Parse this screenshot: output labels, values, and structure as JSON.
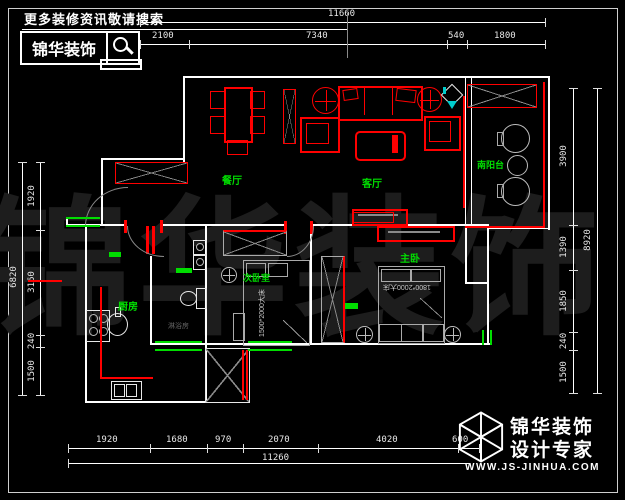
{
  "header": {
    "promo_text": "更多装修资讯敬请搜索",
    "brand": "锦华装饰"
  },
  "watermark": {
    "text": "锦华装饰"
  },
  "plan": {
    "room_labels": {
      "dining": "餐厅",
      "living": "客厅",
      "balcony": "南阳台",
      "second_bedroom": "次卧室",
      "master_bedroom": "主卧",
      "kitchen": "厨房",
      "shower": "淋浴房"
    },
    "furniture_text": {
      "second_bed": "1500*2000大床",
      "master_bed": "1800*2000大床"
    }
  },
  "dimensions": {
    "top": {
      "total": "11660",
      "segments": [
        "2100",
        "7340",
        "540",
        "1800"
      ]
    },
    "bottom": {
      "total": "11260",
      "segments": [
        "1920",
        "1680",
        "970",
        "2070",
        "4020",
        "600"
      ]
    },
    "left": {
      "total": "6820",
      "segments": [
        "1920",
        "3160",
        "240",
        "1500"
      ]
    },
    "right": {
      "total": "8920",
      "segments": [
        "3900",
        "1390",
        "1850",
        "240",
        "1500"
      ]
    }
  },
  "footer_logo": {
    "brand": "锦华装饰",
    "tagline": "设计专家",
    "website": "WWW.JS-JINHUA.COM"
  },
  "colors": {
    "wall": "#ffffff",
    "furniture_red": "#ff0000",
    "label_green": "#00dd00",
    "dim_text": "#e8e8e8",
    "watermark": "#1d1d1d",
    "accent_cyan": "#00cccc"
  }
}
